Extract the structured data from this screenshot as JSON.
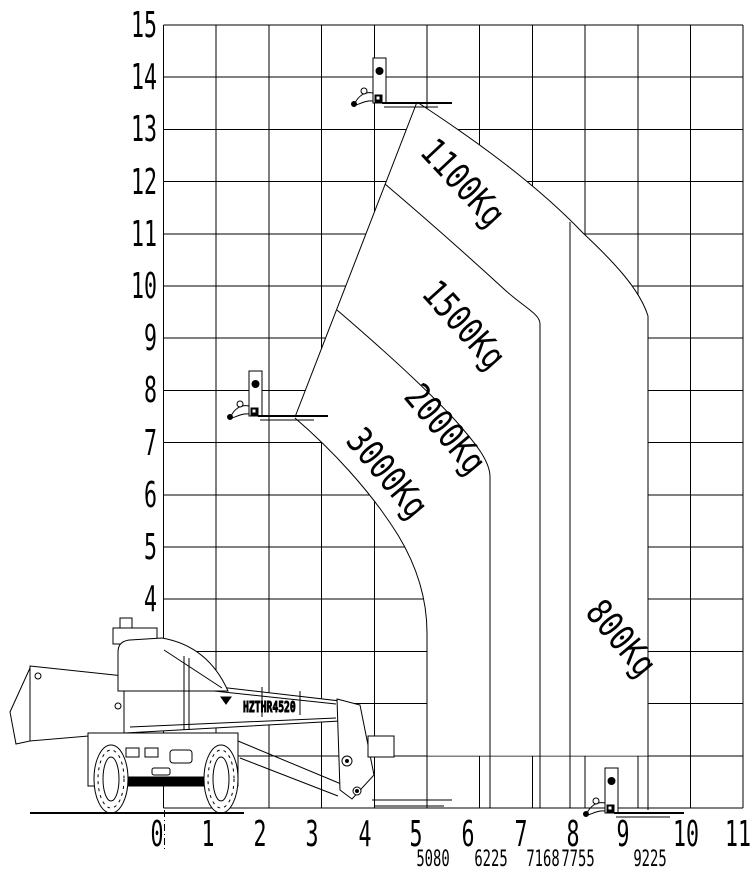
{
  "chart_data": {
    "type": "area",
    "title": "Telehandler lifting capacity load chart",
    "xlabel": "Reach (m)",
    "ylabel": "Lift height (m)",
    "xlim": [
      0,
      11
    ],
    "ylim": [
      0,
      15
    ],
    "grid": true,
    "legend_position": "none",
    "max_lift_height_m": 13.5,
    "zones": [
      {
        "capacity": "3000Kg",
        "max_reach_mm": 5080,
        "reach_range_m": [
          0,
          5.08
        ]
      },
      {
        "capacity": "2000Kg",
        "max_reach_mm": 6225,
        "reach_range_m": [
          5.08,
          6.225
        ]
      },
      {
        "capacity": "1500Kg",
        "max_reach_mm": 7168,
        "reach_range_m": [
          6.225,
          7.168
        ]
      },
      {
        "capacity": "1100Kg",
        "max_reach_mm": 7755,
        "reach_range_m": [
          7.168,
          7.755
        ]
      },
      {
        "capacity": "800Kg",
        "max_reach_mm": 9225,
        "reach_range_m": [
          7.755,
          9.225
        ]
      }
    ],
    "fork_reference_positions": [
      {
        "height_m": 13.5,
        "reach_m": 4.2
      },
      {
        "height_m": 7.5,
        "reach_m": 1.9
      },
      {
        "height_m": 0.0,
        "reach_m": 8.6
      }
    ]
  },
  "y_axis": {
    "labels": [
      "15",
      "14",
      "13",
      "12",
      "11",
      "10",
      "9",
      "8",
      "7",
      "6",
      "5",
      "4",
      "3"
    ]
  },
  "x_axis": {
    "labels": [
      "0",
      "1",
      "2",
      "3",
      "4",
      "5",
      "6",
      "7",
      "8",
      "9",
      "10",
      "11"
    ],
    "reach_mm_labels": [
      "5080",
      "6225",
      "7168",
      "7755",
      "9225"
    ]
  },
  "zones": {
    "labels": [
      "1100Kg",
      "1500Kg",
      "2000Kg",
      "3000Kg",
      "800Kg"
    ]
  },
  "machine": {
    "model": "HZTHR4520"
  },
  "colors": {
    "line": "#000000",
    "background": "#ffffff"
  }
}
